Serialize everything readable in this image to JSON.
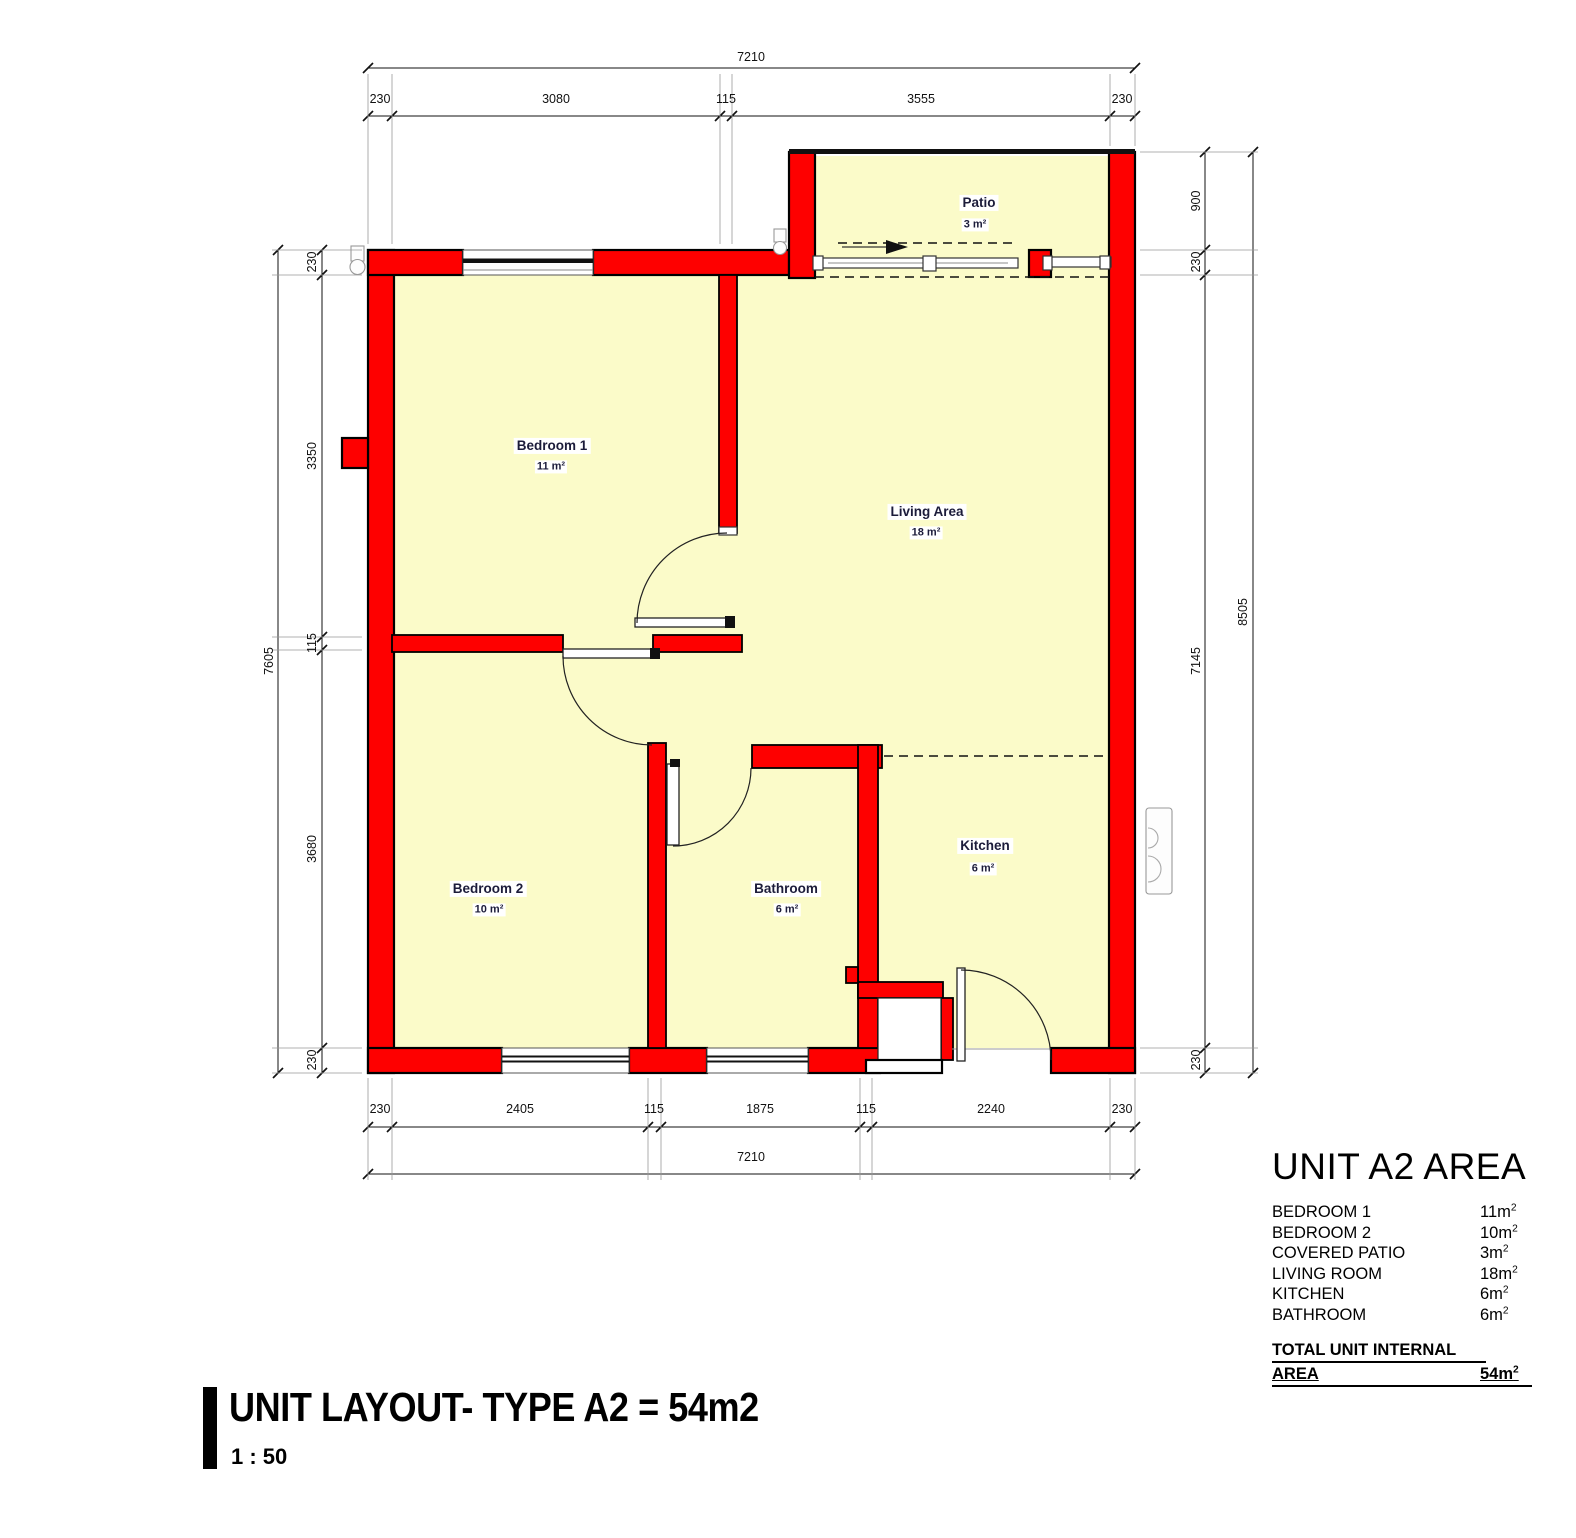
{
  "title_block": {
    "title": "UNIT LAYOUT- TYPE A2 = 54m2",
    "scale": "1 : 50"
  },
  "legend": {
    "title": "UNIT A2 AREA",
    "rows": [
      {
        "label": "BEDROOM 1",
        "value": "11m²"
      },
      {
        "label": "BEDROOM 2",
        "value": "10m²"
      },
      {
        "label": "COVERED PATIO",
        "value": "3m²"
      },
      {
        "label": "LIVING ROOM",
        "value": "18m²"
      },
      {
        "label": "KITCHEN",
        "value": "6m²"
      },
      {
        "label": "BATHROOM",
        "value": "6m²"
      }
    ],
    "total_label_line1": "TOTAL UNIT INTERNAL",
    "total_label_line2": "AREA",
    "total_value": "54m²"
  },
  "rooms": {
    "bedroom1": {
      "name": "Bedroom 1",
      "area": "11 m²"
    },
    "bedroom2": {
      "name": "Bedroom 2",
      "area": "10 m²"
    },
    "living": {
      "name": "Living Area",
      "area": "18 m²"
    },
    "kitchen": {
      "name": "Kitchen",
      "area": "6 m²"
    },
    "bathroom": {
      "name": "Bathroom",
      "area": "6 m²"
    },
    "patio": {
      "name": "Patio",
      "area": "3 m²"
    }
  },
  "dimensions": {
    "top_overall": "7210",
    "top_segments": [
      "230",
      "3080",
      "115",
      "3555",
      "230"
    ],
    "bottom_segments": [
      "230",
      "2405",
      "115",
      "1875",
      "115",
      "2240",
      "230"
    ],
    "bottom_overall": "7210",
    "left_overall": "7605",
    "left_segments": [
      "230",
      "3350",
      "115",
      "3680",
      "230"
    ],
    "right_segments": [
      "900",
      "230",
      "7145",
      "230"
    ],
    "right_overall": "8505"
  },
  "colors": {
    "wall": "#fe0000",
    "room_fill": "#fbfbc9",
    "label_text": "#1c1c3a",
    "line": "#111111"
  }
}
